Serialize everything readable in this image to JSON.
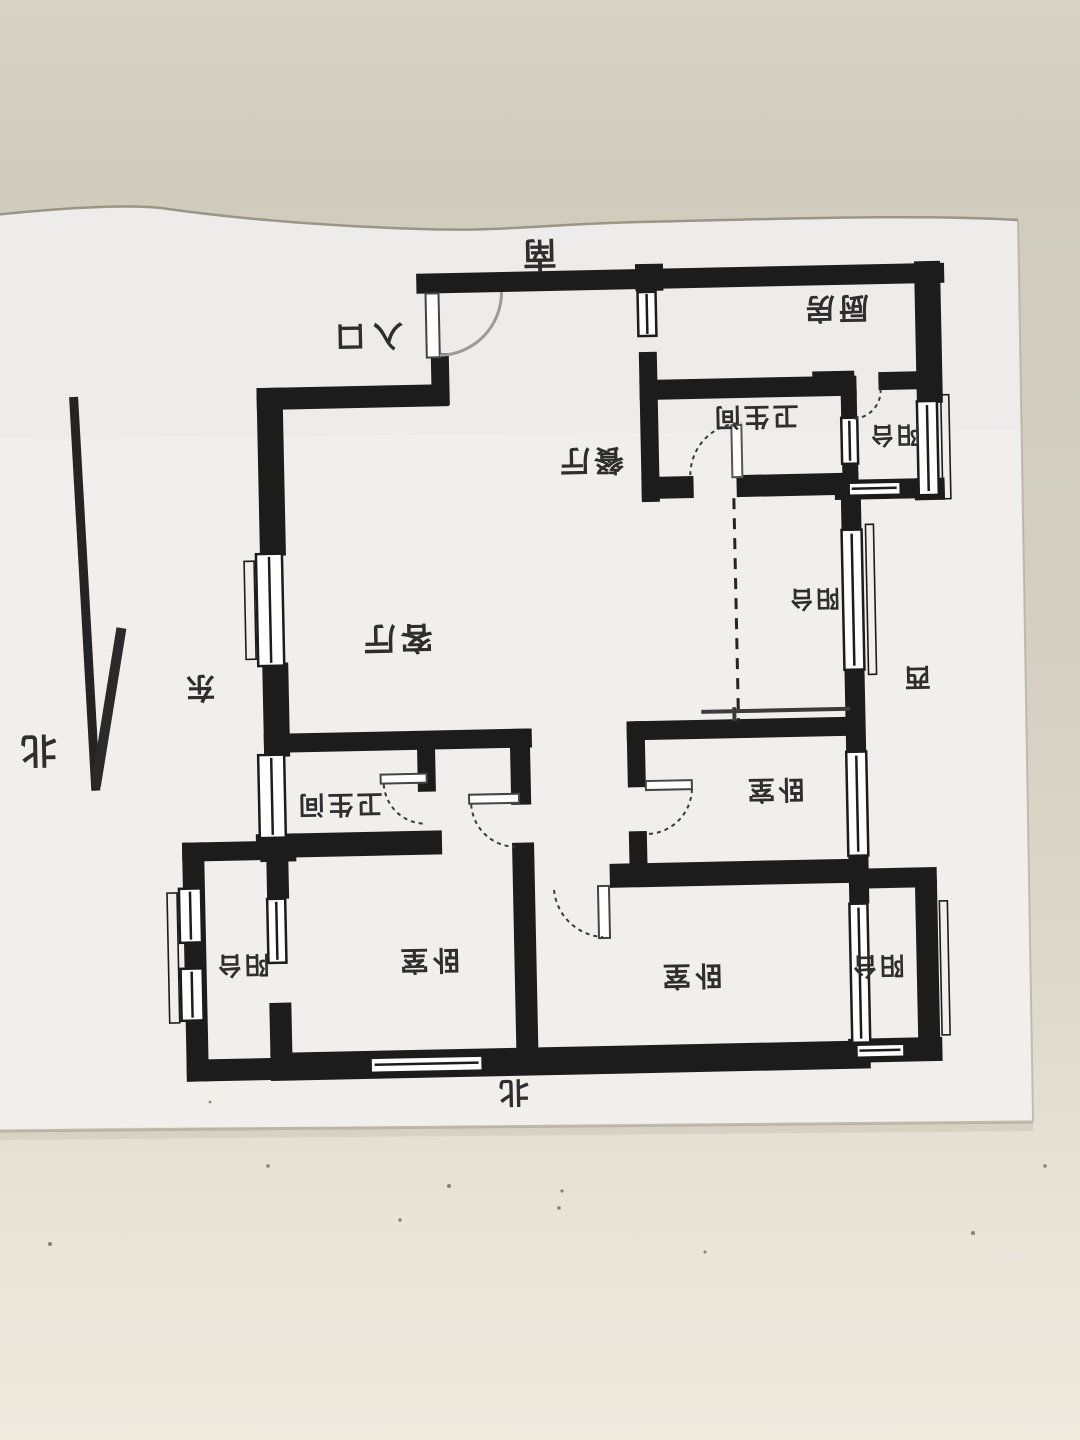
{
  "photo": {
    "desk_color": "#d2cdbe",
    "desk_color_bottom": "#e9e3d9",
    "paper_color": "#f1efec",
    "ink_color": "#1c1c1c",
    "text_color": "#2e2e2e"
  },
  "compass": {
    "south": "南",
    "east": "东",
    "west": "西",
    "north_bottom": "北",
    "north_arrow": "北"
  },
  "plan": {
    "entrance": "入口",
    "rooms": {
      "kitchen": "厨房",
      "bathroom_top": "卫生间",
      "balcony_top_right": "阳台",
      "dining": "餐厅",
      "living": "客厅",
      "balcony_east": "阳台",
      "bedroom_east": "卧室",
      "bathroom_center": "卫生间",
      "balcony_bottom_left": "阳台",
      "bedroom_bottom_left": "卧室",
      "bedroom_bottom_right": "卧室",
      "balcony_bottom_right": "阳台"
    }
  }
}
